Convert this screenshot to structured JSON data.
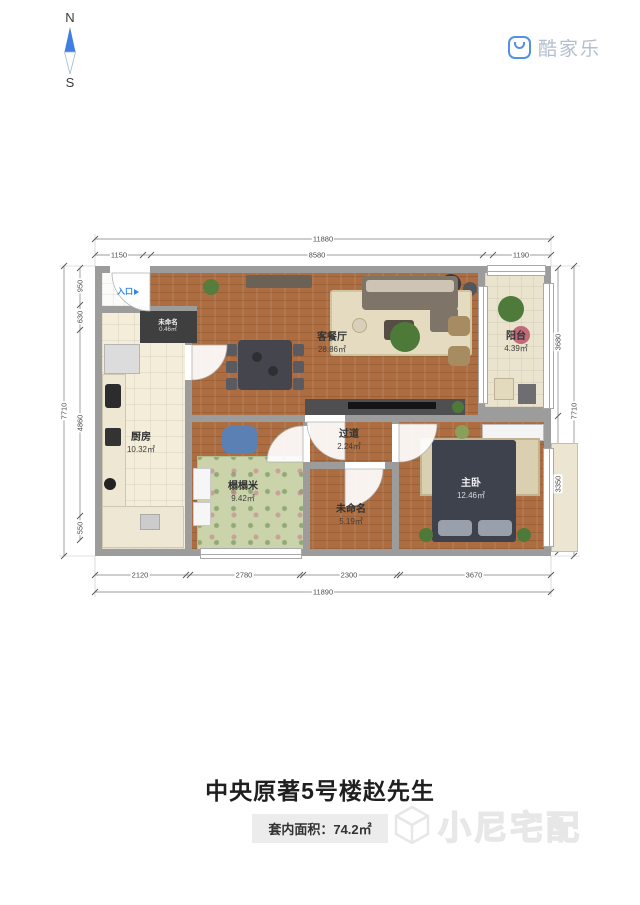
{
  "compass": {
    "north": "N",
    "south": "S",
    "arrow_color": "#3f7ee2"
  },
  "brand": {
    "logo_text": "酷家乐",
    "logo_color": "#5291e3"
  },
  "plan": {
    "entry_label": "入口",
    "rooms": [
      {
        "name": "客餐厅",
        "area": "28.86㎡"
      },
      {
        "name": "阳台",
        "area": "4.39㎡"
      },
      {
        "name": "厨房",
        "area": "10.32㎡"
      },
      {
        "name": "过道",
        "area": "2.24㎡"
      },
      {
        "name": "榻榻米",
        "area": "9.42㎡"
      },
      {
        "name": "未命名",
        "area": "5.19㎡"
      },
      {
        "name": "主卧",
        "area": "12.46㎡"
      },
      {
        "name": "未命名",
        "area": "0.46㎡"
      }
    ],
    "dimensions": {
      "top_total": "11880",
      "top_segments": [
        "1150",
        "8580",
        "1190"
      ],
      "bottom_segments": [
        "2120",
        "2780",
        "2300",
        "3670"
      ],
      "bottom_total": "11890",
      "left_total": "7710",
      "left_segments": [
        "950",
        "630",
        "4860",
        "550"
      ],
      "right_total": "7710",
      "right_segments": [
        "3680",
        "3350"
      ]
    }
  },
  "footer": {
    "title": "中央原著5号楼赵先生",
    "area_label": "套内面积：74.2㎡",
    "watermark": "小尼宅配"
  }
}
